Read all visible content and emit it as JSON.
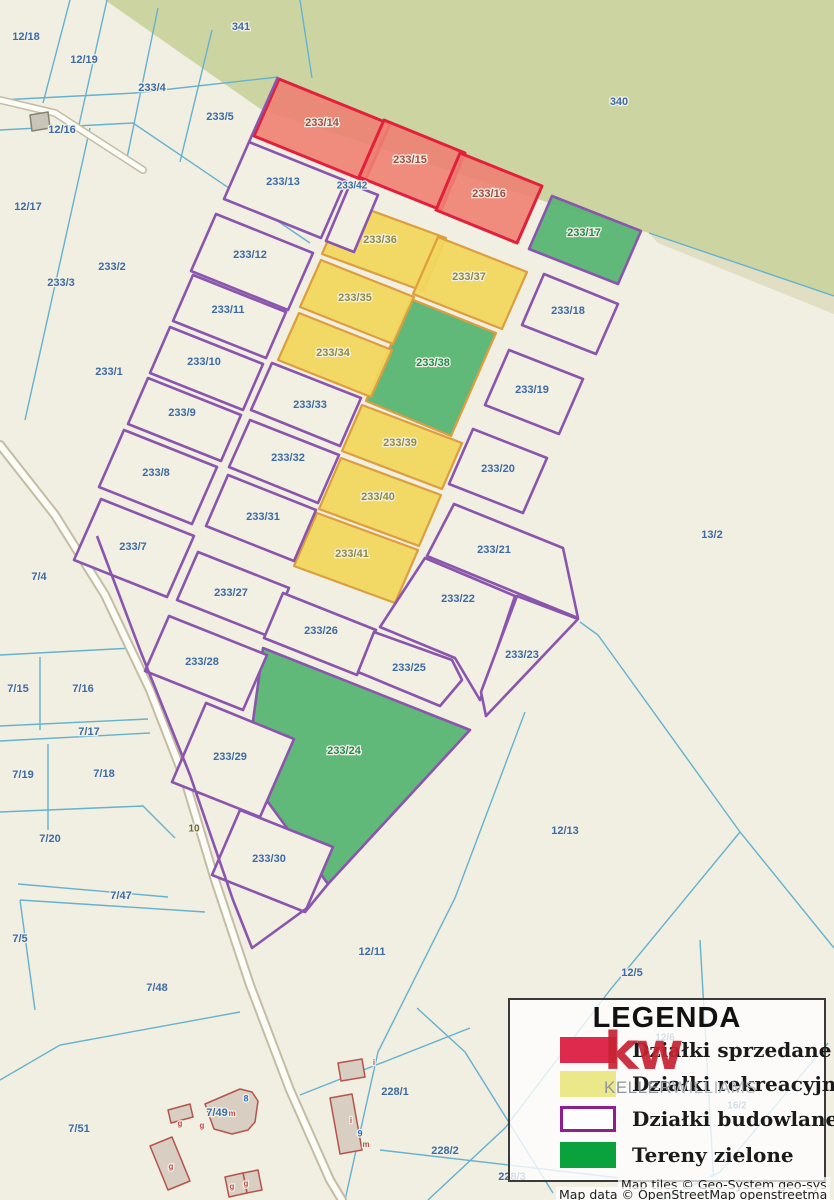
{
  "map": {
    "colors": {
      "background": "#f1eee2",
      "forest": "#ccd5a2",
      "forest_strip": "#e0dfc3",
      "boundary_cyan": "#64b2cf",
      "purple": "#8a55ad",
      "plot_fill": "#f2efe3",
      "sold_fill": "#ee8173",
      "sold_stroke": "#e2203c",
      "rec_fill": "#f1d65e",
      "rec_stroke": "#dd9e3f",
      "green_fill": "#55b470",
      "road_casing": "#c4bca3",
      "road_fill": "#fdfdf7",
      "building_fill": "#d9cec2",
      "building_stroke": "#b5534d",
      "shed_fill": "#c9c5bb",
      "shed_stroke": "#87826f",
      "label_blue": "#3c6ba5",
      "label_red": "#a3493f",
      "label_olive": "#8f8a3d",
      "label_green": "#1f8a4d",
      "label_road": "#6f672d",
      "label_bldg_red": "#c0504c",
      "label_bldg_blue": "#2f6fd0"
    },
    "green_areas": [
      {
        "name": "forest-340-341",
        "points": "105,0 834,0 834,296 649,233 556,205 262,110",
        "fill": "forest"
      },
      {
        "name": "forest-edge-strip",
        "points": "649,233 834,296 834,314 658,243",
        "fill": "forest_strip"
      }
    ],
    "cyan_lines": [
      "70,0 43,103",
      "107,0 79,125",
      "158,8 127,158",
      "212,30 180,162",
      "0,100 135,93 278,77",
      "0,130 133,123 310,243",
      "90,128 25,420",
      "300,0 312,78",
      "649,233 834,296",
      "0,655 133,648",
      "40,657 40,730",
      "0,726 148,719",
      "0,741 150,733",
      "48,744 48,830",
      "0,812 143,806 175,838",
      "18,884 168,897",
      "20,900 205,912",
      "20,900 35,1010",
      "0,1080 60,1045 240,1012",
      "525,712 455,898 378,1052 345,1200",
      "580,622 598,635 740,832 834,948",
      "740,832 610,990 505,1128 428,1200",
      "828,1043 720,1172 662,1200",
      "700,940 714,1185",
      "300,1095 470,1028",
      "417,1008 465,1052 553,1193",
      "380,1150 620,1178"
    ],
    "roads": [
      {
        "name": "road-10",
        "points": "0,445 55,515 105,595 150,690 185,780 215,880 250,985 290,1090 330,1180 342,1200",
        "w_casing": 10,
        "w_fill": 6
      },
      {
        "name": "road-stub-12-16",
        "points": "0,100 55,113 143,170",
        "w_casing": 8,
        "w_fill": 5
      }
    ],
    "parcels": [
      {
        "id": "233/14",
        "st": "sold",
        "points": "279,79 390,124 365,181 254,136"
      },
      {
        "id": "233/15",
        "st": "sold",
        "points": "384,120 465,153 441,210 359,177"
      },
      {
        "id": "233/16",
        "st": "sold",
        "points": "460,153 542,186 517,243 436,210"
      },
      {
        "id": "233/17",
        "st": "green",
        "points": "552,196 641,231 618,284 529,249"
      },
      {
        "id": "233/24",
        "st": "green",
        "points": "263,648 470,730 328,884 246,772"
      },
      {
        "id": "233/38",
        "st": "green_o",
        "points": "411,299 496,333 451,436 366,401"
      },
      {
        "id": "233/36",
        "st": "rec",
        "points": "345,201 446,238 423,291 322,254"
      },
      {
        "id": "233/37",
        "st": "rec",
        "points": "438,237 527,272 502,329 413,294"
      },
      {
        "id": "233/35",
        "st": "rec",
        "points": "321,260 414,297 393,344 300,307"
      },
      {
        "id": "233/34",
        "st": "rec",
        "points": "299,313 392,350 371,397 278,360"
      },
      {
        "id": "233/39",
        "st": "rec",
        "points": "362,405 462,443 442,489 342,451"
      },
      {
        "id": "233/40",
        "st": "rec",
        "points": "341,458 441,495 419,546 319,509"
      },
      {
        "id": "233/41",
        "st": "rec",
        "points": "317,513 418,550 395,603 294,566"
      },
      {
        "id": "233/13",
        "st": "plot",
        "points": "249,142 346,181 321,238 224,199"
      },
      {
        "id": "233/42",
        "st": "plot",
        "points": "350,184 378,195 354,252 326,241"
      },
      {
        "id": "233/12",
        "st": "plot",
        "points": "216,214 313,253 288,310 191,271"
      },
      {
        "id": "233/11",
        "st": "plot",
        "points": "193,275 286,312 266,358 173,321"
      },
      {
        "id": "233/10",
        "st": "plot",
        "points": "170,327 263,364 243,410 150,373"
      },
      {
        "id": "233/9",
        "st": "plot",
        "points": "148,378 241,415 221,461 128,424"
      },
      {
        "id": "233/8",
        "st": "plot",
        "points": "124,430 217,467 192,524 99,487"
      },
      {
        "id": "233/7",
        "st": "plot",
        "points": "101,499 194,536 167,597 74,560"
      },
      {
        "id": "233/33",
        "st": "plot",
        "points": "272,363 361,398 340,446 251,410"
      },
      {
        "id": "233/32",
        "st": "plot",
        "points": "250,420 339,455 318,503 229,467"
      },
      {
        "id": "233/31",
        "st": "plot",
        "points": "228,475 316,510 294,561 206,526"
      },
      {
        "id": "233/27",
        "st": "plot",
        "points": "198,552 289,588 268,636 177,600"
      },
      {
        "id": "233/26",
        "st": "plot",
        "points": "283,593 376,630 357,675 264,638"
      },
      {
        "id": "233/25",
        "st": "plot",
        "points": "374,632 452,660 462,680 440,706 358,672"
      },
      {
        "id": "233/22",
        "st": "plot",
        "points": "425,558 515,596 480,700 455,658 380,627"
      },
      {
        "id": "233/23",
        "st": "plot",
        "points": "517,596 578,619 486,716 481,692"
      },
      {
        "id": "233/21",
        "st": "plot",
        "points": "454,504 563,548 578,618 427,556"
      },
      {
        "id": "233/20",
        "st": "plot",
        "points": "473,429 547,458 523,513 449,484"
      },
      {
        "id": "233/19",
        "st": "plot",
        "points": "509,350 583,379 559,434 485,405"
      },
      {
        "id": "233/18",
        "st": "plot",
        "points": "544,274 618,304 596,354 522,325"
      },
      {
        "id": "233/28",
        "st": "plot",
        "points": "169,616 267,655 243,710 145,671"
      },
      {
        "id": "233/29",
        "st": "plot",
        "points": "206,703 294,739 260,817 172,782"
      },
      {
        "id": "233/30",
        "st": "plot",
        "points": "240,810 333,847 305,912 212,875"
      }
    ],
    "purple_lines": [
      "97,536 140,650 190,775 233,900 252,948 307,908",
      "328,884 305,912",
      "249,142 278,77"
    ],
    "buildings": [
      {
        "name": "shed",
        "points": "30,115 48,112 50,128 32,131",
        "shed": true
      },
      {
        "name": "house-7-49-main",
        "points": "205,1104 240,1089 252,1092 258,1101 255,1122 248,1130 232,1134 214,1129"
      },
      {
        "name": "house-7-49-left",
        "points": "168,1110 190,1104 193,1117 171,1123"
      },
      {
        "name": "barn-7-49",
        "points": "150,1146 172,1137 190,1181 168,1190"
      },
      {
        "name": "outbuilding-1",
        "points": "243,1173 258,1170 262,1190 247,1193"
      },
      {
        "name": "outbuilding-2",
        "points": "225,1177 243,1173 247,1193 229,1197"
      },
      {
        "name": "house-228-1a",
        "points": "338,1063 362,1059 365,1077 341,1081"
      },
      {
        "name": "house-228-1b",
        "points": "330,1098 352,1094 362,1150 340,1154"
      }
    ],
    "labels": [
      {
        "t": "12/18",
        "x": 26,
        "y": 37,
        "c": "b"
      },
      {
        "t": "12/19",
        "x": 84,
        "y": 60,
        "c": "b"
      },
      {
        "t": "233/4",
        "x": 152,
        "y": 88,
        "c": "b"
      },
      {
        "t": "233/5",
        "x": 220,
        "y": 117,
        "c": "b"
      },
      {
        "t": "341",
        "x": 241,
        "y": 27,
        "c": "b"
      },
      {
        "t": "340",
        "x": 619,
        "y": 102,
        "c": "b"
      },
      {
        "t": "12/16",
        "x": 62,
        "y": 130,
        "c": "b"
      },
      {
        "t": "12/17",
        "x": 28,
        "y": 207,
        "c": "b"
      },
      {
        "t": "233/2",
        "x": 112,
        "y": 267,
        "c": "b"
      },
      {
        "t": "233/3",
        "x": 61,
        "y": 283,
        "c": "b"
      },
      {
        "t": "233/1",
        "x": 109,
        "y": 372,
        "c": "b"
      },
      {
        "t": "7/4",
        "x": 39,
        "y": 577,
        "c": "b"
      },
      {
        "t": "13/2",
        "x": 712,
        "y": 535,
        "c": "b"
      },
      {
        "t": "7/15",
        "x": 18,
        "y": 689,
        "c": "b"
      },
      {
        "t": "7/16",
        "x": 83,
        "y": 689,
        "c": "b"
      },
      {
        "t": "7/17",
        "x": 89,
        "y": 732,
        "c": "b"
      },
      {
        "t": "7/19",
        "x": 23,
        "y": 775,
        "c": "b"
      },
      {
        "t": "7/18",
        "x": 104,
        "y": 774,
        "c": "b"
      },
      {
        "t": "7/20",
        "x": 50,
        "y": 839,
        "c": "b"
      },
      {
        "t": "7/47",
        "x": 121,
        "y": 896,
        "c": "b"
      },
      {
        "t": "7/5",
        "x": 20,
        "y": 939,
        "c": "b"
      },
      {
        "t": "7/48",
        "x": 157,
        "y": 988,
        "c": "b"
      },
      {
        "t": "12/11",
        "x": 372,
        "y": 952,
        "c": "b"
      },
      {
        "t": "12/13",
        "x": 565,
        "y": 831,
        "c": "b"
      },
      {
        "t": "7/51",
        "x": 79,
        "y": 1129,
        "c": "b"
      },
      {
        "t": "7/49",
        "x": 217,
        "y": 1113,
        "c": "b"
      },
      {
        "t": "228/1",
        "x": 395,
        "y": 1092,
        "c": "b"
      },
      {
        "t": "228/2",
        "x": 445,
        "y": 1151,
        "c": "b"
      },
      {
        "t": "228/3",
        "x": 512,
        "y": 1177,
        "c": "b"
      },
      {
        "t": "12/5",
        "x": 632,
        "y": 973,
        "c": "b"
      },
      {
        "t": "12/6",
        "x": 665,
        "y": 1038,
        "c": "b",
        "s": 10
      },
      {
        "t": "16/2",
        "x": 737,
        "y": 1106,
        "c": "b",
        "s": 10
      },
      {
        "t": "233/13",
        "x": 283,
        "y": 182,
        "c": "b"
      },
      {
        "t": "233/42",
        "x": 352,
        "y": 186,
        "c": "b",
        "s": 10
      },
      {
        "t": "233/12",
        "x": 250,
        "y": 255,
        "c": "b"
      },
      {
        "t": "233/11",
        "x": 228,
        "y": 310,
        "c": "b"
      },
      {
        "t": "233/10",
        "x": 204,
        "y": 362,
        "c": "b"
      },
      {
        "t": "233/9",
        "x": 182,
        "y": 413,
        "c": "b"
      },
      {
        "t": "233/8",
        "x": 156,
        "y": 473,
        "c": "b"
      },
      {
        "t": "233/7",
        "x": 133,
        "y": 547,
        "c": "b"
      },
      {
        "t": "233/33",
        "x": 310,
        "y": 405,
        "c": "b"
      },
      {
        "t": "233/32",
        "x": 288,
        "y": 458,
        "c": "b"
      },
      {
        "t": "233/31",
        "x": 263,
        "y": 517,
        "c": "b"
      },
      {
        "t": "233/27",
        "x": 231,
        "y": 593,
        "c": "b"
      },
      {
        "t": "233/26",
        "x": 321,
        "y": 631,
        "c": "b"
      },
      {
        "t": "233/28",
        "x": 202,
        "y": 662,
        "c": "b"
      },
      {
        "t": "233/25",
        "x": 409,
        "y": 668,
        "c": "b"
      },
      {
        "t": "233/29",
        "x": 230,
        "y": 757,
        "c": "b"
      },
      {
        "t": "233/30",
        "x": 269,
        "y": 859,
        "c": "b"
      },
      {
        "t": "233/22",
        "x": 458,
        "y": 599,
        "c": "b"
      },
      {
        "t": "233/23",
        "x": 522,
        "y": 655,
        "c": "b"
      },
      {
        "t": "233/21",
        "x": 494,
        "y": 550,
        "c": "b"
      },
      {
        "t": "233/20",
        "x": 498,
        "y": 469,
        "c": "b"
      },
      {
        "t": "233/19",
        "x": 532,
        "y": 390,
        "c": "b"
      },
      {
        "t": "233/18",
        "x": 568,
        "y": 311,
        "c": "b"
      },
      {
        "t": "233/14",
        "x": 322,
        "y": 123,
        "c": "r"
      },
      {
        "t": "233/15",
        "x": 410,
        "y": 160,
        "c": "r"
      },
      {
        "t": "233/16",
        "x": 489,
        "y": 194,
        "c": "r"
      },
      {
        "t": "233/36",
        "x": 380,
        "y": 240,
        "c": "y"
      },
      {
        "t": "233/37",
        "x": 469,
        "y": 277,
        "c": "y"
      },
      {
        "t": "233/35",
        "x": 355,
        "y": 298,
        "c": "y"
      },
      {
        "t": "233/34",
        "x": 333,
        "y": 353,
        "c": "y"
      },
      {
        "t": "233/39",
        "x": 400,
        "y": 443,
        "c": "y"
      },
      {
        "t": "233/40",
        "x": 378,
        "y": 497,
        "c": "y"
      },
      {
        "t": "233/41",
        "x": 352,
        "y": 554,
        "c": "y"
      },
      {
        "t": "233/17",
        "x": 584,
        "y": 233,
        "c": "g"
      },
      {
        "t": "233/38",
        "x": 433,
        "y": 363,
        "c": "g"
      },
      {
        "t": "233/24",
        "x": 344,
        "y": 751,
        "c": "g"
      },
      {
        "t": "10",
        "x": 194,
        "y": 829,
        "c": "o",
        "s": 10
      },
      {
        "t": "g",
        "x": 180,
        "y": 1124,
        "c": "br",
        "s": 8
      },
      {
        "t": "g",
        "x": 202,
        "y": 1126,
        "c": "br",
        "s": 8
      },
      {
        "t": "m",
        "x": 232,
        "y": 1114,
        "c": "br",
        "s": 8
      },
      {
        "t": "8",
        "x": 246,
        "y": 1099,
        "c": "bi",
        "s": 9
      },
      {
        "t": "g",
        "x": 171,
        "y": 1167,
        "c": "br",
        "s": 8
      },
      {
        "t": "g",
        "x": 232,
        "y": 1187,
        "c": "br",
        "s": 8
      },
      {
        "t": "g",
        "x": 246,
        "y": 1184,
        "c": "br",
        "s": 8
      },
      {
        "t": "i",
        "x": 351,
        "y": 1121,
        "c": "br",
        "s": 8
      },
      {
        "t": "9",
        "x": 360,
        "y": 1134,
        "c": "bi",
        "s": 9
      },
      {
        "t": "m",
        "x": 366,
        "y": 1145,
        "c": "br",
        "s": 8
      },
      {
        "t": "i",
        "x": 374,
        "y": 1063,
        "c": "br",
        "s": 8
      }
    ]
  },
  "legend": {
    "title": "LEGENDA",
    "items": [
      {
        "label": "Działki sprzedane",
        "swatch_fill": "#dd2a4d",
        "swatch_border": "#dd2a4d"
      },
      {
        "label": "Działki rekreacyjne",
        "swatch_fill": "#ebe88a",
        "swatch_border": "#ebe88a"
      },
      {
        "label": "Działki budowlane",
        "swatch_fill": "#ffffff",
        "swatch_border": "#8e1f8f"
      },
      {
        "label": "Tereny zielone",
        "swatch_fill": "#0aa23c",
        "swatch_border": "#0aa23c"
      }
    ],
    "watermark": {
      "kw": "kw",
      "keller": "KELLER",
      "williams": "WILLIAMS",
      "kw_color": "#c82333",
      "keller_color": "#8f979e",
      "williams_color": "#b4bac0"
    }
  },
  "attribution": {
    "line1": "Map tiles © Geo-System geo-sys",
    "line2": "Map data © OpenStreetMap openstreetma"
  }
}
